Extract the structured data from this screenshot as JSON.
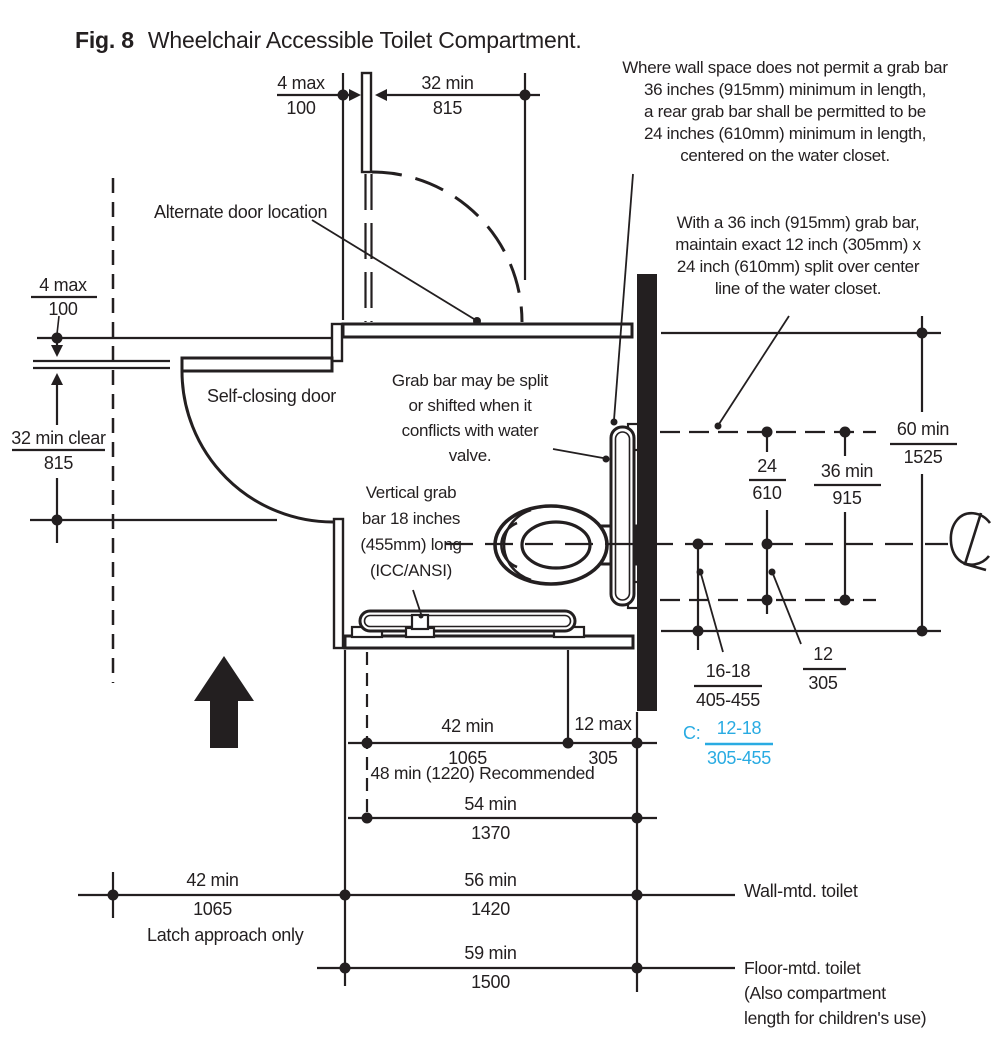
{
  "title": {
    "fig": "Fig. 8",
    "text": "Wheelchair Accessible Toilet Compartment."
  },
  "colors": {
    "line": "#231f20",
    "accent_cyan": "#29abe2"
  },
  "icons": {
    "approach_arrow": "up-arrow",
    "centerline_symbol": "centerline-glyph"
  },
  "notes": {
    "rear_grab_bar": "Where wall space does not permit a grab bar\n36 inches (915mm) minimum in length,\na rear grab bar shall be permitted to be\n24 inches (610mm) minimum in length,\ncentered on the water closet.",
    "split_grab_bar": "With a 36 inch (915mm) grab bar,\nmaintain exact 12 inch (305mm) x\n24 inch (610mm) split over center\nline of the water closet.",
    "grab_bar_shift": "Grab bar may be split\nor shifted when it\nconflicts with water\nvalve.",
    "vertical_grab_bar": "Vertical grab\nbar 18 inches\n(455mm) long\n(ICC/ANSI)",
    "alternate_door": "Alternate door location",
    "self_closing_door": "Self-closing door",
    "recommended": "48 min (1220) Recommended",
    "latch_approach": "Latch approach only",
    "wall_mounted": "Wall-mtd. toilet",
    "floor_mounted": "Floor-mtd. toilet\n(Also compartment\nlength for children's use)"
  },
  "dims": {
    "door_offset_top": {
      "top": "4 max",
      "bottom": "100"
    },
    "door_width": {
      "top": "32 min",
      "bottom": "815"
    },
    "wall_offset_left": {
      "top": "4 max",
      "bottom": "100"
    },
    "door_clear_width": {
      "top": "32 min clear",
      "bottom": "815"
    },
    "rear_split_24": {
      "top": "24",
      "bottom": "610"
    },
    "rear_grab_36": {
      "top": "36 min",
      "bottom": "915"
    },
    "compartment_width_60": {
      "top": "60 min",
      "bottom": "1525"
    },
    "wc_centerline_16_18": {
      "top": "16-18",
      "bottom": "405-455"
    },
    "grab_beyond_12": {
      "top": "12",
      "bottom": "305"
    },
    "children_centerline": {
      "prefix": "C:",
      "top": "12-18",
      "bottom": "305-455"
    },
    "clearance_42": {
      "top": "42 min",
      "bottom": "1065"
    },
    "transfer_12_max": {
      "top": "12 max",
      "bottom": "305"
    },
    "depth_54": {
      "top": "54 min",
      "bottom": "1370"
    },
    "latch_42": {
      "top": "42 min",
      "bottom": "1065"
    },
    "wall_mounted_depth_56": {
      "top": "56 min",
      "bottom": "1420"
    },
    "floor_mounted_depth_59": {
      "top": "59 min",
      "bottom": "1500"
    }
  }
}
